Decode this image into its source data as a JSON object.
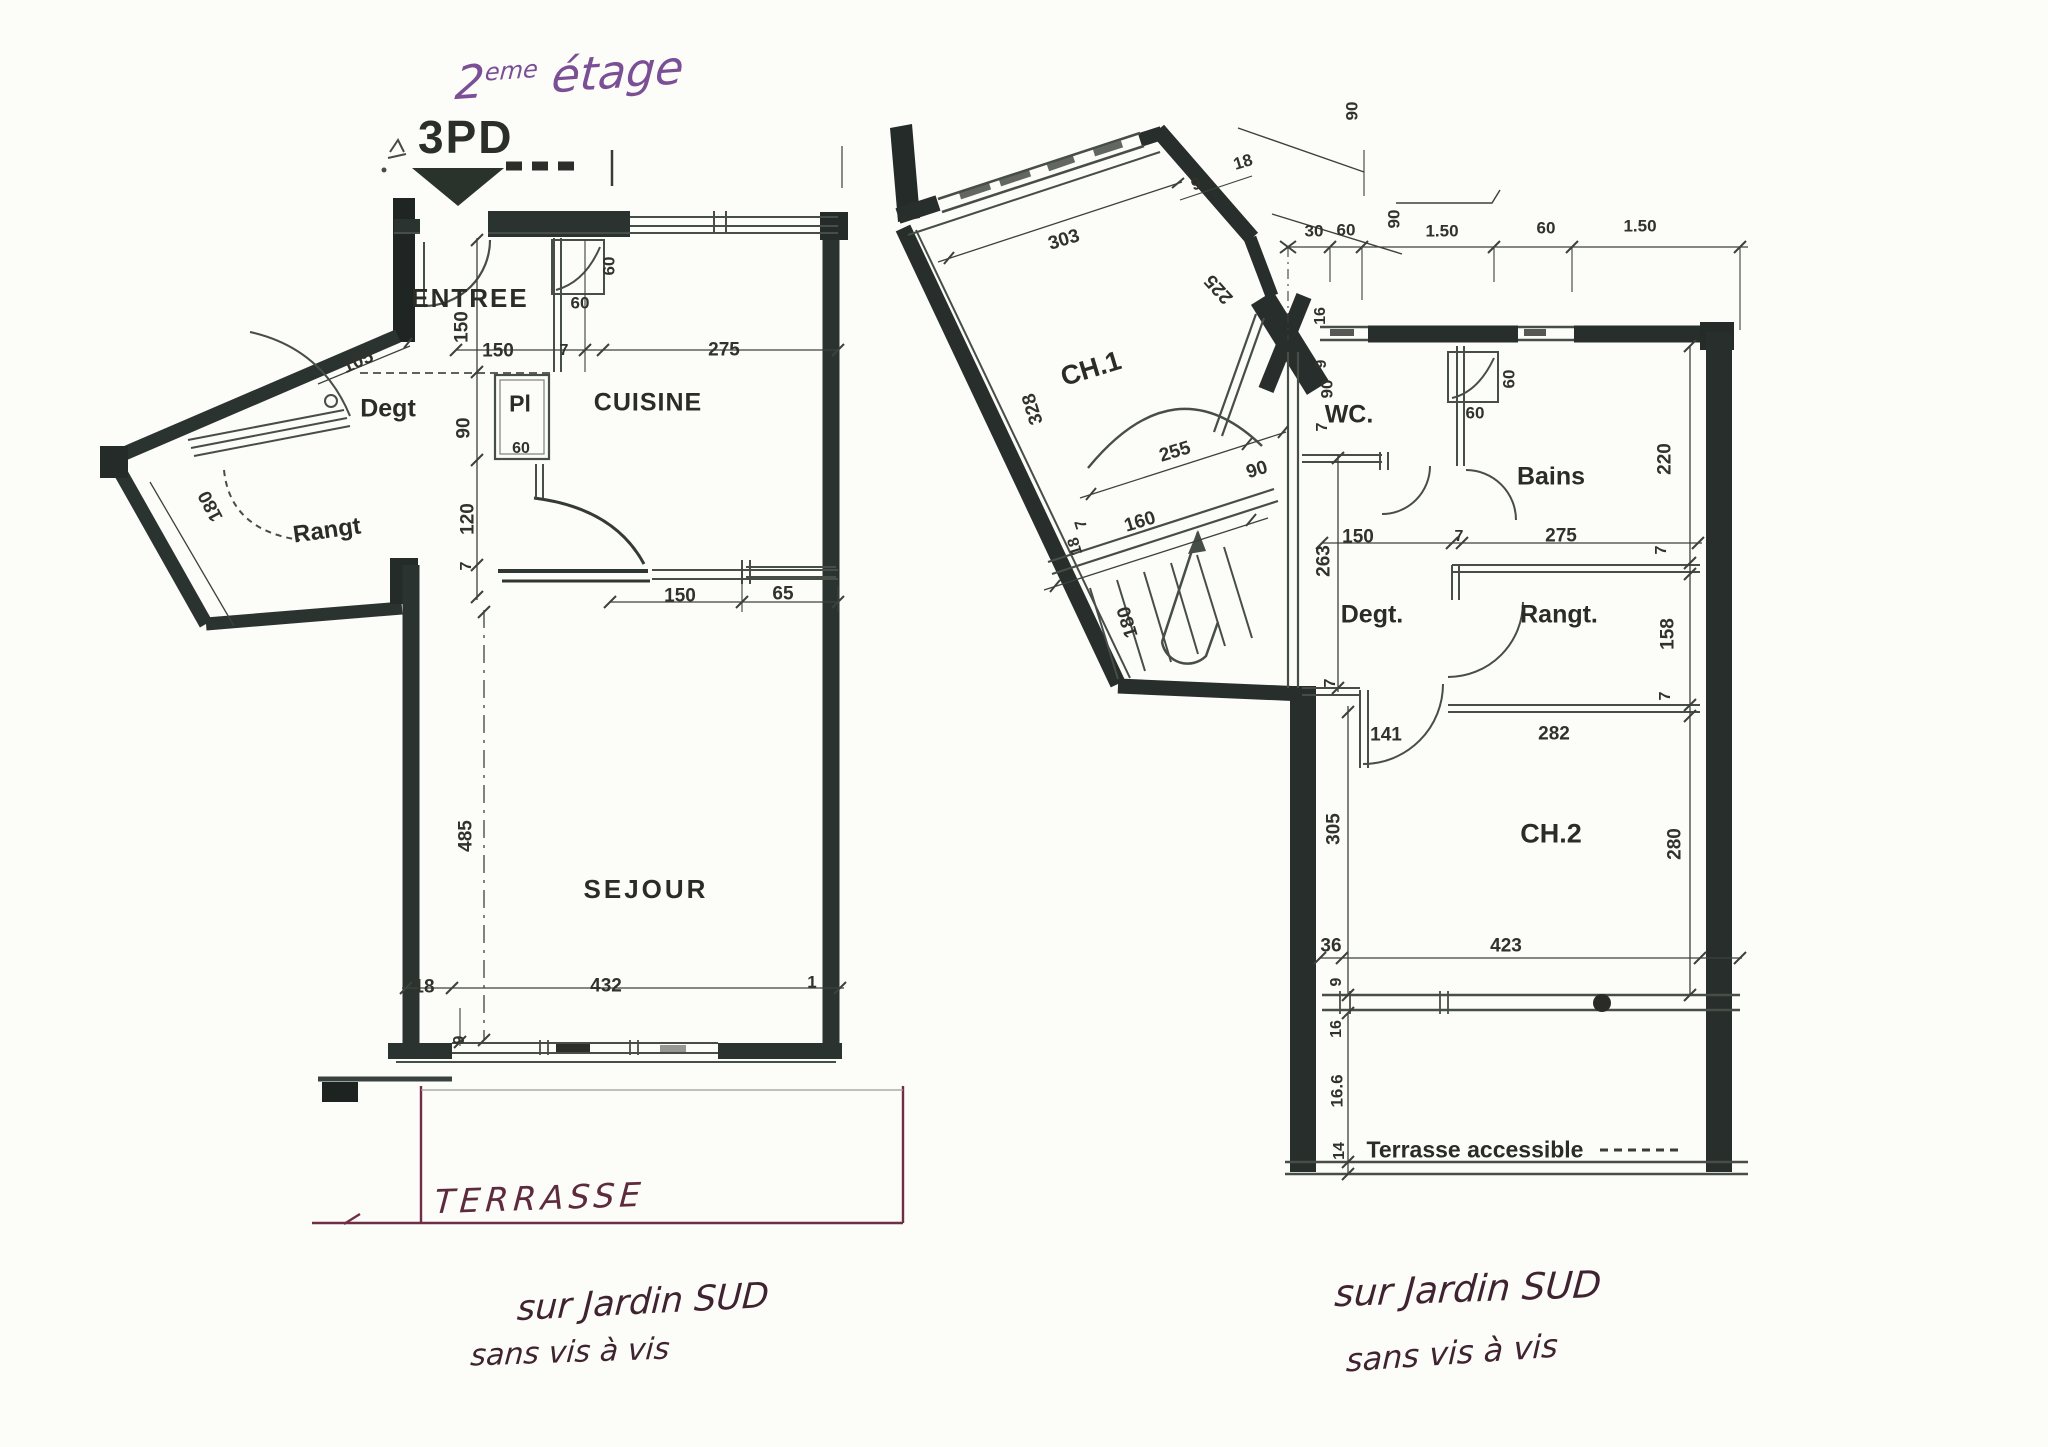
{
  "title": {
    "number": "2",
    "ordinal": "eme",
    "word": "étage",
    "plan_code": "3PD"
  },
  "left_plan": {
    "room_labels": [
      {
        "t": "ENTREE",
        "x": 470,
        "y": 298,
        "s": 26,
        "ls": 2,
        "n": "room-label-entree"
      },
      {
        "t": "Degt",
        "x": 388,
        "y": 409,
        "s": 25,
        "n": "room-label-degagement"
      },
      {
        "t": "Rangt",
        "x": 327,
        "y": 531,
        "s": 24,
        "r": -8,
        "n": "room-label-rangement"
      },
      {
        "t": "Pl",
        "x": 520,
        "y": 404,
        "s": 23,
        "n": "room-label-placard"
      },
      {
        "t": "CUISINE",
        "x": 648,
        "y": 403,
        "s": 25,
        "ls": 1,
        "n": "room-label-cuisine"
      },
      {
        "t": "SEJOUR",
        "x": 646,
        "y": 889,
        "s": 26,
        "ls": 3,
        "n": "room-label-sejour"
      }
    ],
    "dim_labels": [
      {
        "t": "150",
        "x": 498,
        "y": 351
      },
      {
        "t": "7",
        "x": 564,
        "y": 351,
        "s": 16
      },
      {
        "t": "275",
        "x": 724,
        "y": 350
      },
      {
        "t": "105",
        "x": 358,
        "y": 362,
        "r": -24
      },
      {
        "t": "150",
        "x": 462,
        "y": 327,
        "r": -90
      },
      {
        "t": "90",
        "x": 464,
        "y": 428,
        "r": -90
      },
      {
        "t": "120",
        "x": 468,
        "y": 519,
        "r": -90
      },
      {
        "t": "7",
        "x": 467,
        "y": 566,
        "r": -90,
        "s": 16
      },
      {
        "t": "180",
        "x": 211,
        "y": 506,
        "r": -118
      },
      {
        "t": "60",
        "x": 609,
        "y": 266,
        "r": -90,
        "s": 17
      },
      {
        "t": "60",
        "x": 580,
        "y": 303,
        "s": 17
      },
      {
        "t": "60",
        "x": 521,
        "y": 449,
        "s": 16
      },
      {
        "t": "150",
        "x": 680,
        "y": 596
      },
      {
        "t": "65",
        "x": 783,
        "y": 594
      },
      {
        "t": "485",
        "x": 466,
        "y": 836,
        "r": -90
      },
      {
        "t": "18",
        "x": 424,
        "y": 987
      },
      {
        "t": "432",
        "x": 606,
        "y": 986
      },
      {
        "t": "1",
        "x": 812,
        "y": 982,
        "s": 17
      },
      {
        "t": "9",
        "x": 460,
        "y": 1040,
        "r": -90,
        "s": 16
      }
    ]
  },
  "right_plan": {
    "room_labels": [
      {
        "t": "CH.1",
        "x": 1091,
        "y": 369,
        "s": 27,
        "r": -17,
        "n": "room-label-ch1"
      },
      {
        "t": "WC.",
        "x": 1349,
        "y": 415,
        "s": 25,
        "n": "room-label-wc"
      },
      {
        "t": "Bains",
        "x": 1551,
        "y": 477,
        "s": 25,
        "n": "room-label-bains"
      },
      {
        "t": "Degt.",
        "x": 1372,
        "y": 615,
        "s": 25,
        "n": "room-label-degagement-2"
      },
      {
        "t": "Rangt.",
        "x": 1559,
        "y": 615,
        "s": 25,
        "n": "room-label-rangement-2"
      },
      {
        "t": "CH.2",
        "x": 1551,
        "y": 834,
        "s": 27,
        "n": "room-label-ch2"
      },
      {
        "t": "Terrasse accessible",
        "x": 1475,
        "y": 1150,
        "s": 23,
        "n": "room-label-terrasse-accessible"
      }
    ],
    "dim_labels": [
      {
        "t": "303",
        "x": 1064,
        "y": 240,
        "r": -17
      },
      {
        "t": "9",
        "x": 1196,
        "y": 184,
        "r": -17,
        "s": 17
      },
      {
        "t": "18",
        "x": 1243,
        "y": 162,
        "r": -17,
        "s": 17
      },
      {
        "t": "328",
        "x": 1033,
        "y": 409,
        "r": -107
      },
      {
        "t": "225",
        "x": 1219,
        "y": 289,
        "r": -132
      },
      {
        "t": "90",
        "x": 1352,
        "y": 111,
        "r": -90,
        "s": 17
      },
      {
        "t": "90",
        "x": 1394,
        "y": 219,
        "r": -90,
        "s": 17
      },
      {
        "t": "30",
        "x": 1314,
        "y": 231,
        "s": 17
      },
      {
        "t": "60",
        "x": 1346,
        "y": 230,
        "s": 17
      },
      {
        "t": "1.50",
        "x": 1442,
        "y": 231,
        "s": 17
      },
      {
        "t": "60",
        "x": 1546,
        "y": 228,
        "s": 17
      },
      {
        "t": "1.50",
        "x": 1640,
        "y": 226,
        "s": 17
      },
      {
        "t": "255",
        "x": 1175,
        "y": 452,
        "r": -17
      },
      {
        "t": "90",
        "x": 1257,
        "y": 470,
        "r": -17
      },
      {
        "t": "7",
        "x": 1082,
        "y": 524,
        "r": -107,
        "s": 16
      },
      {
        "t": "160",
        "x": 1140,
        "y": 522,
        "r": -17
      },
      {
        "t": "18",
        "x": 1076,
        "y": 546,
        "r": -107,
        "s": 16
      },
      {
        "t": "180",
        "x": 1128,
        "y": 622,
        "r": -107
      },
      {
        "t": "16",
        "x": 1321,
        "y": 316,
        "r": -90,
        "s": 16
      },
      {
        "t": "9",
        "x": 1322,
        "y": 364,
        "r": -90,
        "s": 16
      },
      {
        "t": "90",
        "x": 1327,
        "y": 389,
        "r": -90,
        "s": 17
      },
      {
        "t": "7",
        "x": 1323,
        "y": 427,
        "r": -90,
        "s": 16
      },
      {
        "t": "60",
        "x": 1509,
        "y": 379,
        "r": -90,
        "s": 17
      },
      {
        "t": "60",
        "x": 1475,
        "y": 413,
        "s": 17
      },
      {
        "t": "150",
        "x": 1358,
        "y": 537
      },
      {
        "t": "7",
        "x": 1459,
        "y": 537,
        "s": 16
      },
      {
        "t": "275",
        "x": 1561,
        "y": 536
      },
      {
        "t": "220",
        "x": 1665,
        "y": 459,
        "r": -90
      },
      {
        "t": "263",
        "x": 1324,
        "y": 561,
        "r": -90
      },
      {
        "t": "7",
        "x": 1662,
        "y": 550,
        "r": -90,
        "s": 16
      },
      {
        "t": "158",
        "x": 1668,
        "y": 634,
        "r": -90
      },
      {
        "t": "7",
        "x": 1331,
        "y": 683,
        "r": -90,
        "s": 16
      },
      {
        "t": "7",
        "x": 1666,
        "y": 696,
        "r": -90,
        "s": 16
      },
      {
        "t": "141",
        "x": 1386,
        "y": 735
      },
      {
        "t": "282",
        "x": 1554,
        "y": 734
      },
      {
        "t": "305",
        "x": 1334,
        "y": 829,
        "r": -90
      },
      {
        "t": "280",
        "x": 1675,
        "y": 844,
        "r": -90
      },
      {
        "t": "36",
        "x": 1331,
        "y": 946
      },
      {
        "t": "423",
        "x": 1506,
        "y": 946
      },
      {
        "t": "9",
        "x": 1337,
        "y": 982,
        "r": -90,
        "s": 16
      },
      {
        "t": "16",
        "x": 1337,
        "y": 1029,
        "r": -90,
        "s": 16
      },
      {
        "t": "16.6",
        "x": 1337,
        "y": 1091,
        "r": -90,
        "s": 17
      },
      {
        "t": "14",
        "x": 1340,
        "y": 1151,
        "r": -90,
        "s": 16
      }
    ]
  },
  "annotations": [
    {
      "t": "TERRASSE",
      "x": 540,
      "y": 1198,
      "s": 33,
      "r": -2,
      "ls": 5,
      "c": "#5d2a3e",
      "n": "terrasse-handwritten-label"
    },
    {
      "t": "sur Jardin SUD",
      "x": 643,
      "y": 1303,
      "s": 35,
      "r": -3,
      "c": "#3f2330",
      "n": "left-note-line1"
    },
    {
      "t": "sans vis à vis",
      "x": 570,
      "y": 1353,
      "s": 30,
      "r": -2,
      "c": "#3f2330",
      "n": "left-note-line2"
    },
    {
      "t": "sur Jardin SUD",
      "x": 1468,
      "y": 1289,
      "s": 37,
      "r": -2,
      "c": "#3f2330",
      "n": "right-note-line1"
    },
    {
      "t": "sans vis à vis",
      "x": 1452,
      "y": 1353,
      "s": 32,
      "r": -4,
      "c": "#3f2330",
      "n": "right-note-line2"
    }
  ]
}
